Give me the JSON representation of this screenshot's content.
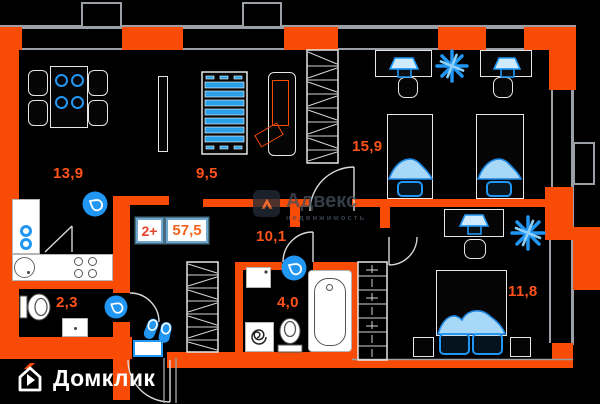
{
  "plan_type": "apartment-floor-plan",
  "badge": {
    "rooms_label": "2+",
    "area_value": "57,5"
  },
  "rooms": [
    {
      "name": "kitchen-living",
      "area": "13,9"
    },
    {
      "name": "living-room",
      "area": "9,5"
    },
    {
      "name": "bedroom-1",
      "area": "15,9"
    },
    {
      "name": "hallway",
      "area": "10,1"
    },
    {
      "name": "bathroom",
      "area": "4,0"
    },
    {
      "name": "wc",
      "area": "2,3"
    },
    {
      "name": "bedroom-2",
      "area": "11,8"
    }
  ],
  "watermark": {
    "brand": "Адвекс",
    "subtitle": "недвижимость"
  },
  "footer": {
    "logo_text": "Домклик"
  },
  "icons": [
    "water-drop-icon",
    "slippers-icon",
    "doormat",
    "plant-icon",
    "desk-lamp-icon",
    "washing-machine-spiral-icon",
    "house-logo-icon",
    "advex-logo-icon"
  ],
  "colors": {
    "wall": "#f84b05",
    "fixture_blue": "#2196f3",
    "label_orange": "#ff531a",
    "line_gray": "#9aa0a6"
  }
}
